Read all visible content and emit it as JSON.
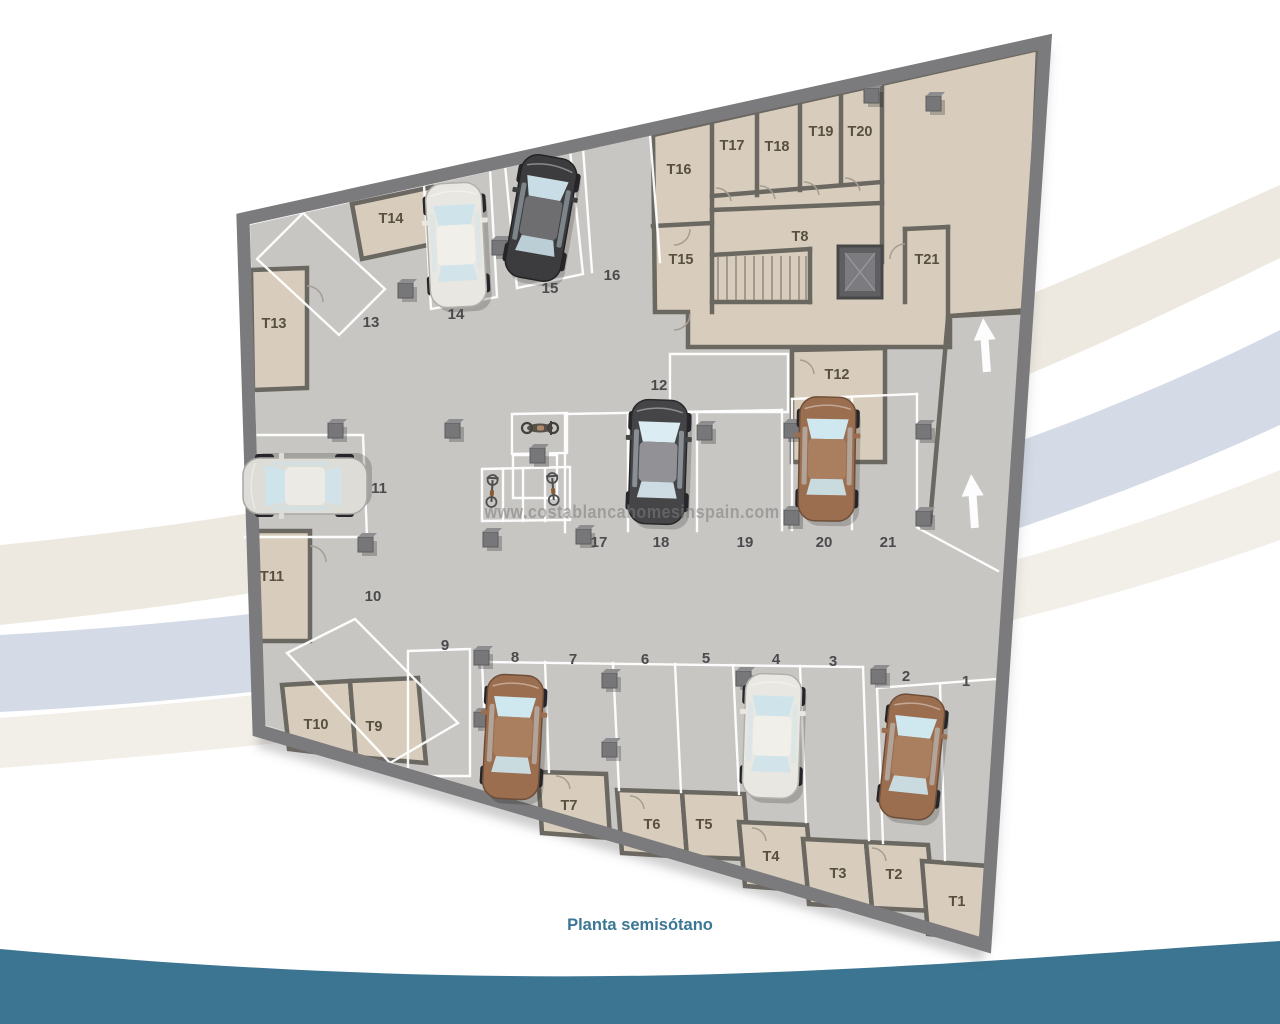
{
  "caption": {
    "text": "Planta semisótano",
    "color": "#3b7795"
  },
  "watermark": {
    "text": "www.costablancahomesinspain.com"
  },
  "palette": {
    "floor": "#c7c6c3",
    "storage_floor": "#d8cdbc",
    "outer_wall": "#7b7b7d",
    "inner_wall": "#6b6761",
    "teal_wave": "#3c7592",
    "swoosh_beige": "#ebe5da",
    "swoosh_blue": "#cfd7e3",
    "stall_line": "#ffffff"
  },
  "plan": {
    "parking_spots": [
      {
        "label": "1",
        "x": 966,
        "y": 686
      },
      {
        "label": "2",
        "x": 906,
        "y": 681
      },
      {
        "label": "3",
        "x": 833,
        "y": 666
      },
      {
        "label": "4",
        "x": 776,
        "y": 664
      },
      {
        "label": "5",
        "x": 706,
        "y": 663
      },
      {
        "label": "6",
        "x": 645,
        "y": 664
      },
      {
        "label": "7",
        "x": 573,
        "y": 664
      },
      {
        "label": "8",
        "x": 515,
        "y": 662
      },
      {
        "label": "9",
        "x": 445,
        "y": 650
      },
      {
        "label": "10",
        "x": 373,
        "y": 601
      },
      {
        "label": "11",
        "x": 379,
        "y": 493
      },
      {
        "label": "12",
        "x": 659,
        "y": 390
      },
      {
        "label": "13",
        "x": 371,
        "y": 327
      },
      {
        "label": "14",
        "x": 456,
        "y": 319
      },
      {
        "label": "15",
        "x": 550,
        "y": 293
      },
      {
        "label": "16",
        "x": 612,
        "y": 280
      },
      {
        "label": "17",
        "x": 599,
        "y": 547
      },
      {
        "label": "18",
        "x": 661,
        "y": 547
      },
      {
        "label": "19",
        "x": 745,
        "y": 547
      },
      {
        "label": "20",
        "x": 824,
        "y": 547
      },
      {
        "label": "21",
        "x": 888,
        "y": 547
      }
    ],
    "storage_rooms": [
      {
        "label": "T1",
        "x": 957,
        "y": 906
      },
      {
        "label": "T2",
        "x": 894,
        "y": 879
      },
      {
        "label": "T3",
        "x": 838,
        "y": 878
      },
      {
        "label": "T4",
        "x": 771,
        "y": 861
      },
      {
        "label": "T5",
        "x": 704,
        "y": 829
      },
      {
        "label": "T6",
        "x": 652,
        "y": 829
      },
      {
        "label": "T7",
        "x": 569,
        "y": 810
      },
      {
        "label": "T8",
        "x": 800,
        "y": 241
      },
      {
        "label": "T9",
        "x": 374,
        "y": 731
      },
      {
        "label": "T10",
        "x": 316,
        "y": 729
      },
      {
        "label": "T11",
        "x": 272,
        "y": 581
      },
      {
        "label": "T12",
        "x": 837,
        "y": 379
      },
      {
        "label": "T13",
        "x": 274,
        "y": 328
      },
      {
        "label": "T14",
        "x": 391,
        "y": 223
      },
      {
        "label": "T15",
        "x": 681,
        "y": 264
      },
      {
        "label": "T16",
        "x": 679,
        "y": 174
      },
      {
        "label": "T17",
        "x": 732,
        "y": 150
      },
      {
        "label": "T18",
        "x": 777,
        "y": 151
      },
      {
        "label": "T19",
        "x": 821,
        "y": 136
      },
      {
        "label": "T20",
        "x": 860,
        "y": 136
      },
      {
        "label": "T21",
        "x": 927,
        "y": 264
      }
    ],
    "cars": [
      {
        "spot": "14",
        "color": "white",
        "x": 456,
        "y": 245,
        "angle": -3
      },
      {
        "spot": "15",
        "color": "dark",
        "x": 541,
        "y": 218,
        "angle": 10
      },
      {
        "spot": "11",
        "color": "silver",
        "x": 305,
        "y": 486,
        "angle": -90
      },
      {
        "spot": "18",
        "color": "dark2",
        "x": 658,
        "y": 462,
        "angle": 2
      },
      {
        "spot": "20",
        "color": "brown",
        "x": 827,
        "y": 459,
        "angle": 1
      },
      {
        "spot": "8",
        "color": "brown",
        "x": 513,
        "y": 737,
        "angle": 3
      },
      {
        "spot": "4",
        "color": "white",
        "x": 772,
        "y": 736,
        "angle": 2
      },
      {
        "spot": "2",
        "color": "brown",
        "x": 912,
        "y": 757,
        "angle": 6
      }
    ],
    "car_colors": {
      "white": {
        "body": "#e9e7e1",
        "roof": "#f1efe9",
        "window": "#cfe3eb",
        "stroke": "#b2b0ab"
      },
      "silver": {
        "body": "#dddcd7",
        "roof": "#eceae5",
        "window": "#cfe3eb",
        "stroke": "#a8a7a2"
      },
      "dark": {
        "body": "#3c3c3e",
        "roof": "#6e6e71",
        "window": "#c9dde6",
        "stroke": "#232326"
      },
      "dark2": {
        "body": "#454548",
        "roof": "#929296",
        "window": "#dcecf3",
        "stroke": "#29292c"
      },
      "brown": {
        "body": "#9b6e50",
        "roof": "#a97f60",
        "window": "#cfe7ef",
        "stroke": "#6e4e38"
      }
    },
    "ramp_arrows": [
      {
        "x": 985,
        "y": 345,
        "angle": -4
      },
      {
        "x": 973,
        "y": 501,
        "angle": -4
      }
    ],
    "two_wheelers": [
      {
        "kind": "motorcycle",
        "x": 540,
        "y": 428,
        "angle": 90
      },
      {
        "kind": "bicycle",
        "x": 492,
        "y": 491,
        "angle": 3
      },
      {
        "kind": "bicycle",
        "x": 553,
        "y": 489,
        "angle": -4
      }
    ]
  }
}
